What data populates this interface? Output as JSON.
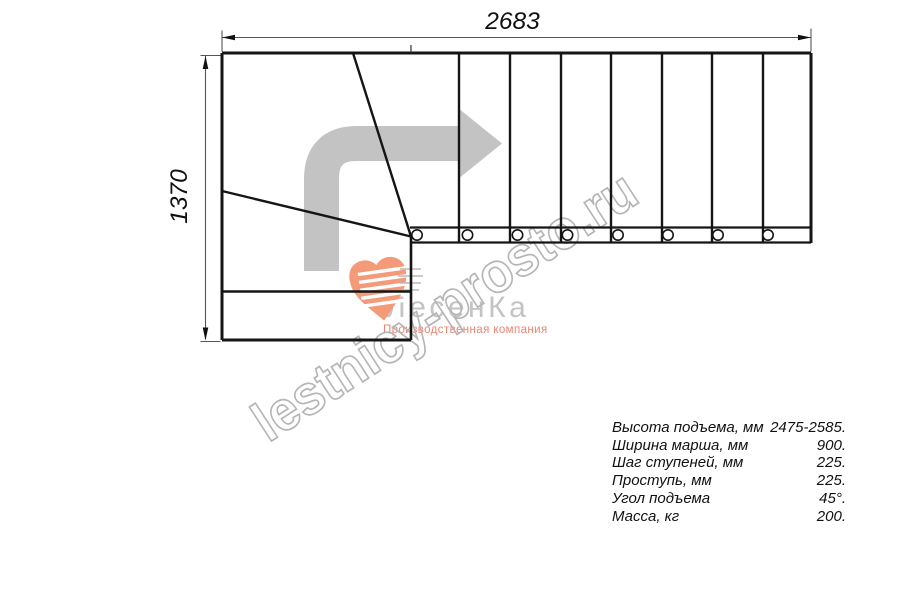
{
  "drawing": {
    "width_dim_label": "2683",
    "height_dim_label": "1370",
    "line_color": "#151515",
    "dimension_line_color": "#555555",
    "direction_arrow_color": "#c3c3c3"
  },
  "watermark": {
    "text": "lestnicy-prosto.ru",
    "outline_color": "#b5b5b5"
  },
  "logo": {
    "brand": "ЛесенКа",
    "subtitle": "Производственная компания",
    "heart_color": "#f49a78",
    "brand_color": "#c4c4c4",
    "subtitle_color": "#ee8472"
  },
  "specs": {
    "rows": [
      {
        "label": "Высота подъема, мм",
        "value": "2475-2585."
      },
      {
        "label": "Ширина марша, мм",
        "value": "900."
      },
      {
        "label": "Шаг ступеней, мм",
        "value": "225."
      },
      {
        "label": "Проступь, мм",
        "value": "225."
      },
      {
        "label": "Угол подъема",
        "value": "45°."
      },
      {
        "label": "Масса, кг",
        "value": "200."
      }
    ]
  }
}
